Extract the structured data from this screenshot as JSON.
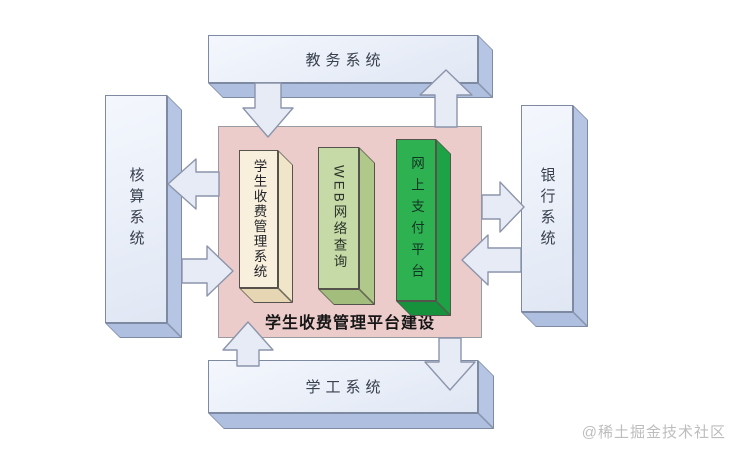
{
  "systems": {
    "top": {
      "label": "教务系统"
    },
    "left": {
      "label": "核算系统"
    },
    "right": {
      "label": "银行系统"
    },
    "bottom": {
      "label": "学工系统"
    }
  },
  "platform": {
    "title": "学生收费管理平台建设",
    "pillars": [
      {
        "label": "学生收费管理系统",
        "color": "#f8efdd"
      },
      {
        "label": "WEB网络查询",
        "color": "#c6daa8"
      },
      {
        "label": "网上支付平台",
        "color": "#2db151"
      }
    ]
  },
  "colors": {
    "panel_background": "#eccccb",
    "system_box_front": "#e9eefa",
    "system_box_side": "#b6c5e3",
    "pillar_outline": "#55534b",
    "arrow_fill": "#e7ebf6",
    "arrow_outline": "#8b94aa"
  },
  "watermark": {
    "text": "@稀土掘金技术社区"
  }
}
